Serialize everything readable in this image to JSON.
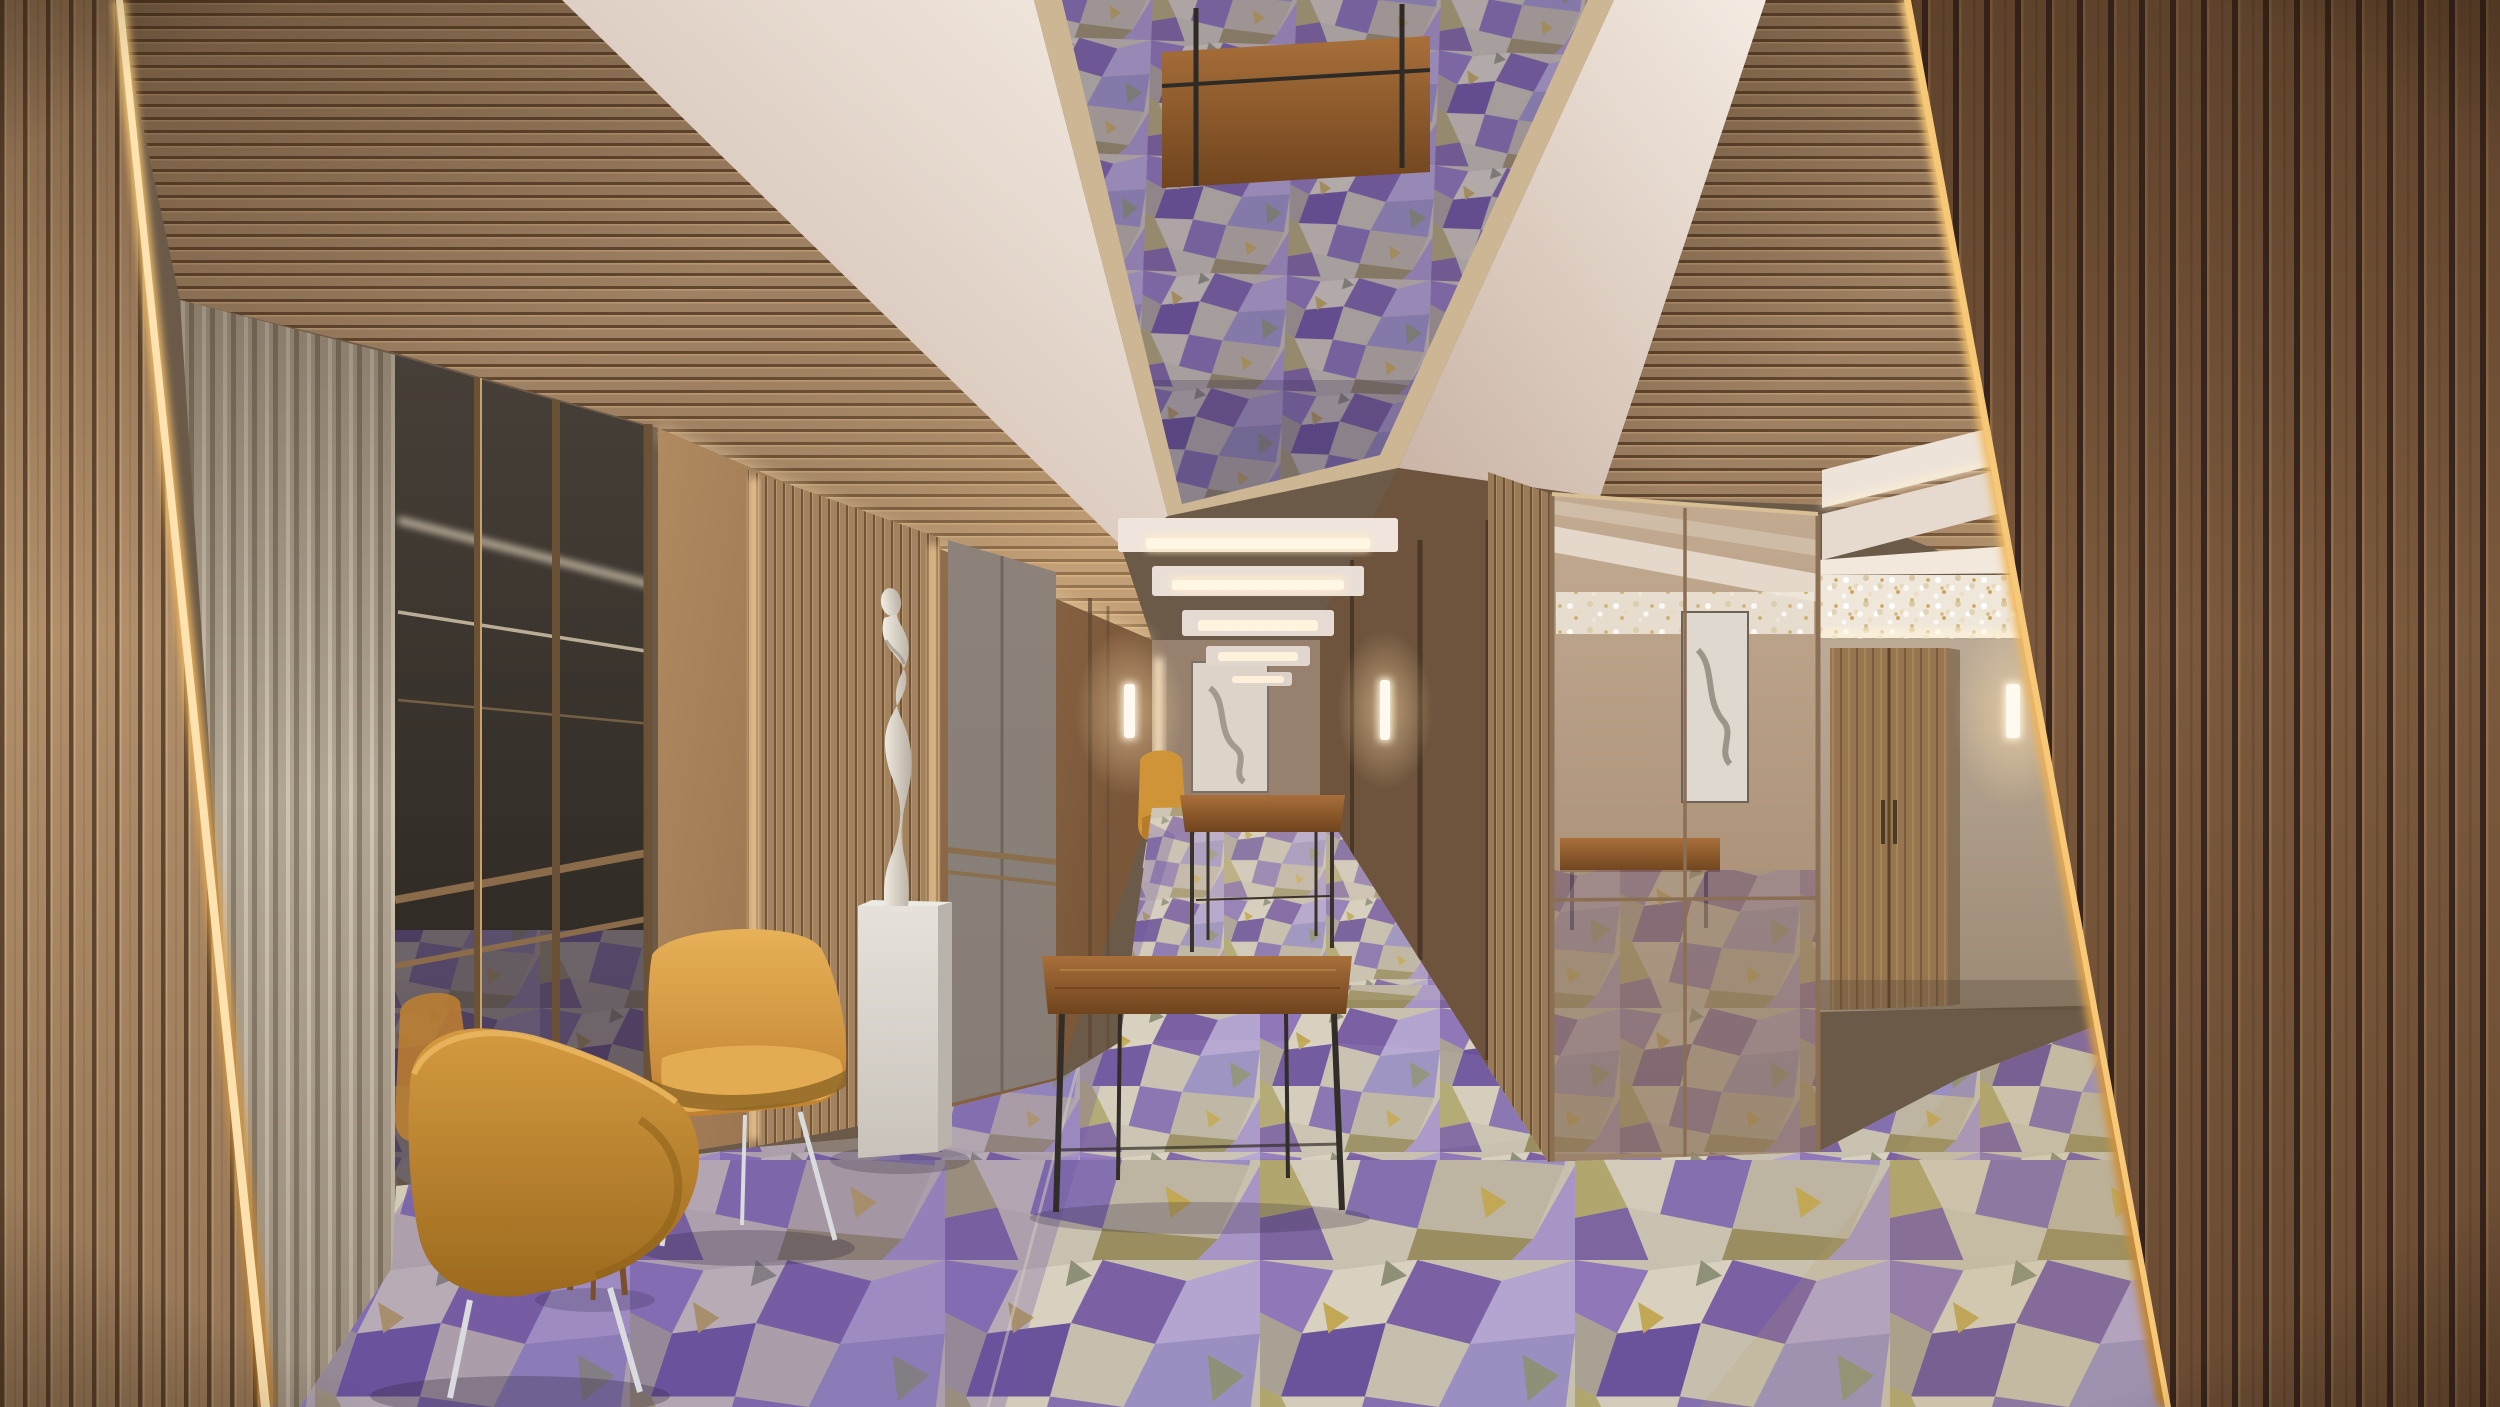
{
  "scene": {
    "description": "Photorealistic rendering of a luxury hotel ballroom pre-function corridor",
    "room": {
      "left_pillar": "light oak vertical slat clad pillar with warm LED edge strip",
      "right_pillar": "dark walnut vertical slat clad pillar with gold lit edge strip",
      "ceiling": "white stepped plaster coves with recessed mirror panel reflecting the carpet, horizontal wood slat soffits",
      "ceiling_light_panels": 5,
      "floor": "geometric patchwork carpet in purple, lavender, cream, grey and olive-gold",
      "left_side": "fluted greige panels, bronze-framed mirror partition, ribbed wood statue niche, grey doors",
      "right_side": "bronze mirror clad column, greige wall with wooden double doors, slatted panel and crystal garland chandelier"
    },
    "objects": {
      "armchairs": {
        "count": 2,
        "upholstery": "mustard velvet",
        "legs": "chrome"
      },
      "distant_armchair": {
        "count": 1,
        "upholstery": "mustard velvet"
      },
      "side_table": {
        "top": "white marble",
        "frame": "wood"
      },
      "console_tables": {
        "count": 2,
        "material": "walnut wood, thin dark metal legs"
      },
      "statue": {
        "type": "abstract white female figure",
        "pedestal": "white marble block"
      },
      "artwork": {
        "count": 2,
        "style": "grey abstract ink on white canvas"
      },
      "wall_sconces": {
        "count": 3,
        "type": "vertical frosted glass, warm light"
      },
      "chandelier": {
        "type": "horizontal crystal and gold garland strip"
      }
    }
  },
  "palette": {
    "wood_oak": "#b28f6b",
    "wood_oak_groove": "#614831",
    "wood_walnut": "#7b593d",
    "wood_walnut_groove": "#38261f",
    "soffit_wood": "#a8896a",
    "flute_greige": "#b1a593",
    "wall_greige": "#b5a390",
    "ceiling_white": "#efe5da",
    "trim_champagne": "#cdb694",
    "carpet_base": "#c9c1b0",
    "carpet_purple": "#7b60a4",
    "carpet_lilac": "#a892c8",
    "carpet_cream": "#d8d1bf",
    "carpet_olive": "#a89a62",
    "chair_mustard": "#d79a3f",
    "chair_mustard_shadow": "#a66f22",
    "chrome": "#d9dbde",
    "marble": "#e5e1da",
    "glow_warm": "#ffedc8",
    "glass_dark": "#35302a",
    "mirror_bronze": "#b49a7f",
    "console_wood": "#96562b",
    "gold_strip": "#e8a74f",
    "statue_white": "#ece6dd",
    "chandelier_base": "#efe7da"
  }
}
